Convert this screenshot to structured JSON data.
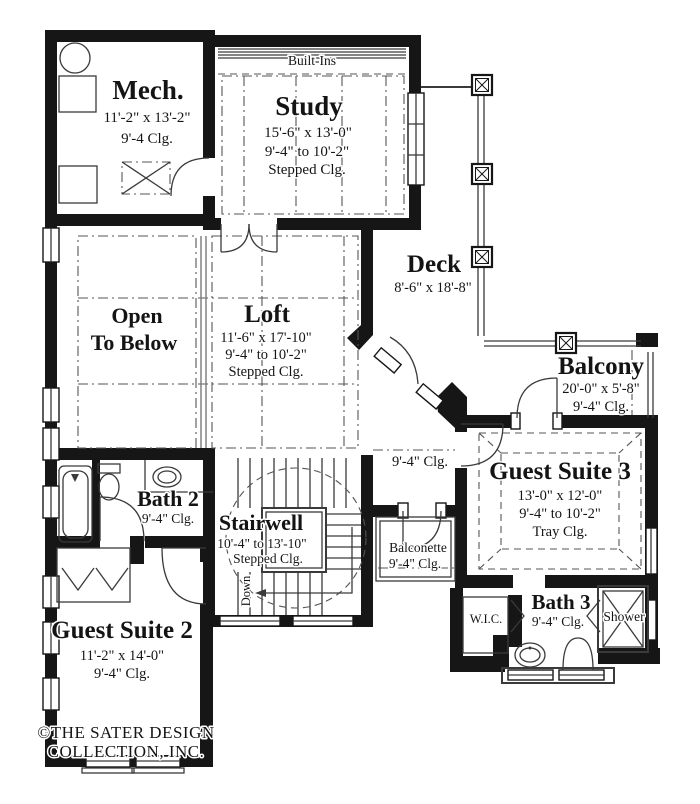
{
  "plan": {
    "builtins_label": "Built-Ins",
    "mech": {
      "name": "Mech.",
      "dim": "11'-2\" x 13'-2\"",
      "clg": "9'-4 Clg."
    },
    "study": {
      "name": "Study",
      "dim": "15'-6\" x 13'-0\"",
      "clg_range": "9'-4\" to 10'-2\"",
      "clg_type": "Stepped Clg."
    },
    "deck": {
      "name": "Deck",
      "dim": "8'-6\" x 18'-8\""
    },
    "open_below": {
      "line1": "Open",
      "line2": "To Below"
    },
    "loft": {
      "name": "Loft",
      "dim": "11'-6\" x 17'-10\"",
      "clg_range": "9'-4\" to 10'-2\"",
      "clg_type": "Stepped Clg."
    },
    "balcony": {
      "name": "Balcony",
      "dim": "20'-0\" x 5'-8\"",
      "clg": "9'-4\" Clg."
    },
    "hall": {
      "clg": "9'-4\" Clg."
    },
    "guest_suite_3": {
      "name": "Guest Suite 3",
      "dim": "13'-0\" x 12'-0\"",
      "clg_range": "9'-4\" to 10'-2\"",
      "clg_type": "Tray Clg."
    },
    "bath_2": {
      "name": "Bath 2",
      "clg": "9'-4\" Clg."
    },
    "stairwell": {
      "name": "Stairwell",
      "dim": "10'-4\" to 13'-10\"",
      "clg_type": "Stepped Clg.",
      "down": "Down"
    },
    "balconette": {
      "name": "Balconette",
      "clg": "9'-4\" Clg."
    },
    "guest_suite_2": {
      "name": "Guest Suite 2",
      "dim": "11'-2\" x 14'-0\"",
      "clg": "9'-4\" Clg."
    },
    "wic": {
      "name": "W.I.C."
    },
    "bath_3": {
      "name": "Bath 3",
      "clg": "9'-4\" Clg."
    },
    "shower": {
      "name": "Shower"
    }
  },
  "footer": {
    "line1": "©THE SATER DESIGN",
    "line2": "COLLECTION, INC."
  },
  "colors": {
    "wall": "#161616",
    "line": "#3a3a3a",
    "ceiling_line": "#555555",
    "background": "#ffffff"
  }
}
